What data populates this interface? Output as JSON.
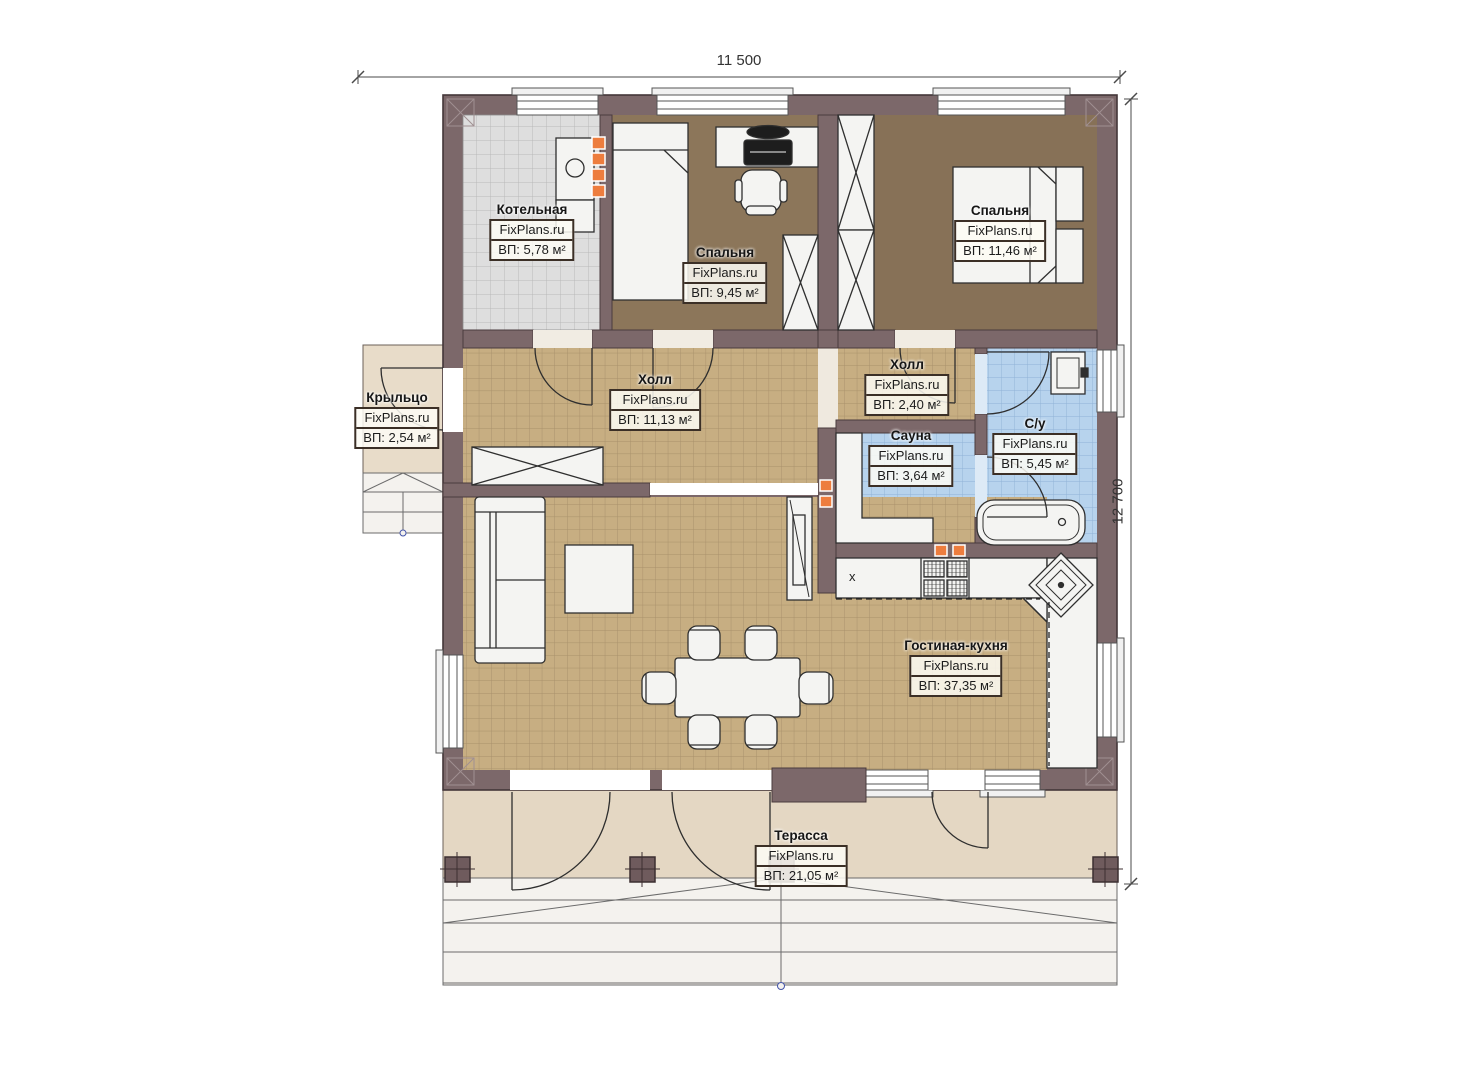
{
  "plan": {
    "dimension_width": "11 500",
    "dimension_height": "12 700",
    "watermark": "FixPlans.ru",
    "kitchen_marker": "х",
    "rooms": [
      {
        "id": "kotelnaya",
        "name": "Котельная",
        "area": "ВП: 5,78 м²"
      },
      {
        "id": "spalnya-1",
        "name": "Спальня",
        "area": "ВП: 9,45 м²"
      },
      {
        "id": "spalnya-2",
        "name": "Спальня",
        "area": "ВП: 11,46 м²"
      },
      {
        "id": "krylco",
        "name": "Крыльцо",
        "area": "ВП: 2,54 м²"
      },
      {
        "id": "holl",
        "name": "Холл",
        "area": "ВП: 11,13 м²"
      },
      {
        "id": "holl-2",
        "name": "Холл",
        "area": "ВП: 2,40 м²"
      },
      {
        "id": "sauna",
        "name": "Сауна",
        "area": "ВП: 3,64 м²"
      },
      {
        "id": "su",
        "name": "С/у",
        "area": "ВП: 5,45 м²"
      },
      {
        "id": "gostinaya",
        "name": "Гостиная-кухня",
        "area": "ВП: 37,35 м²"
      },
      {
        "id": "terassa",
        "name": "Терасса",
        "area": "ВП: 21,05 м²"
      }
    ],
    "colors": {
      "wall": "#7c686a",
      "floor_tile_tan": "#c7ae82",
      "floor_tile_blue": "#b7d3ed",
      "floor_tile_gray": "#dedede",
      "floor_wood_brown": "#8c765a",
      "terrace_beige": "#e4d7c3",
      "accent_orange": "#ed7d3e"
    }
  }
}
